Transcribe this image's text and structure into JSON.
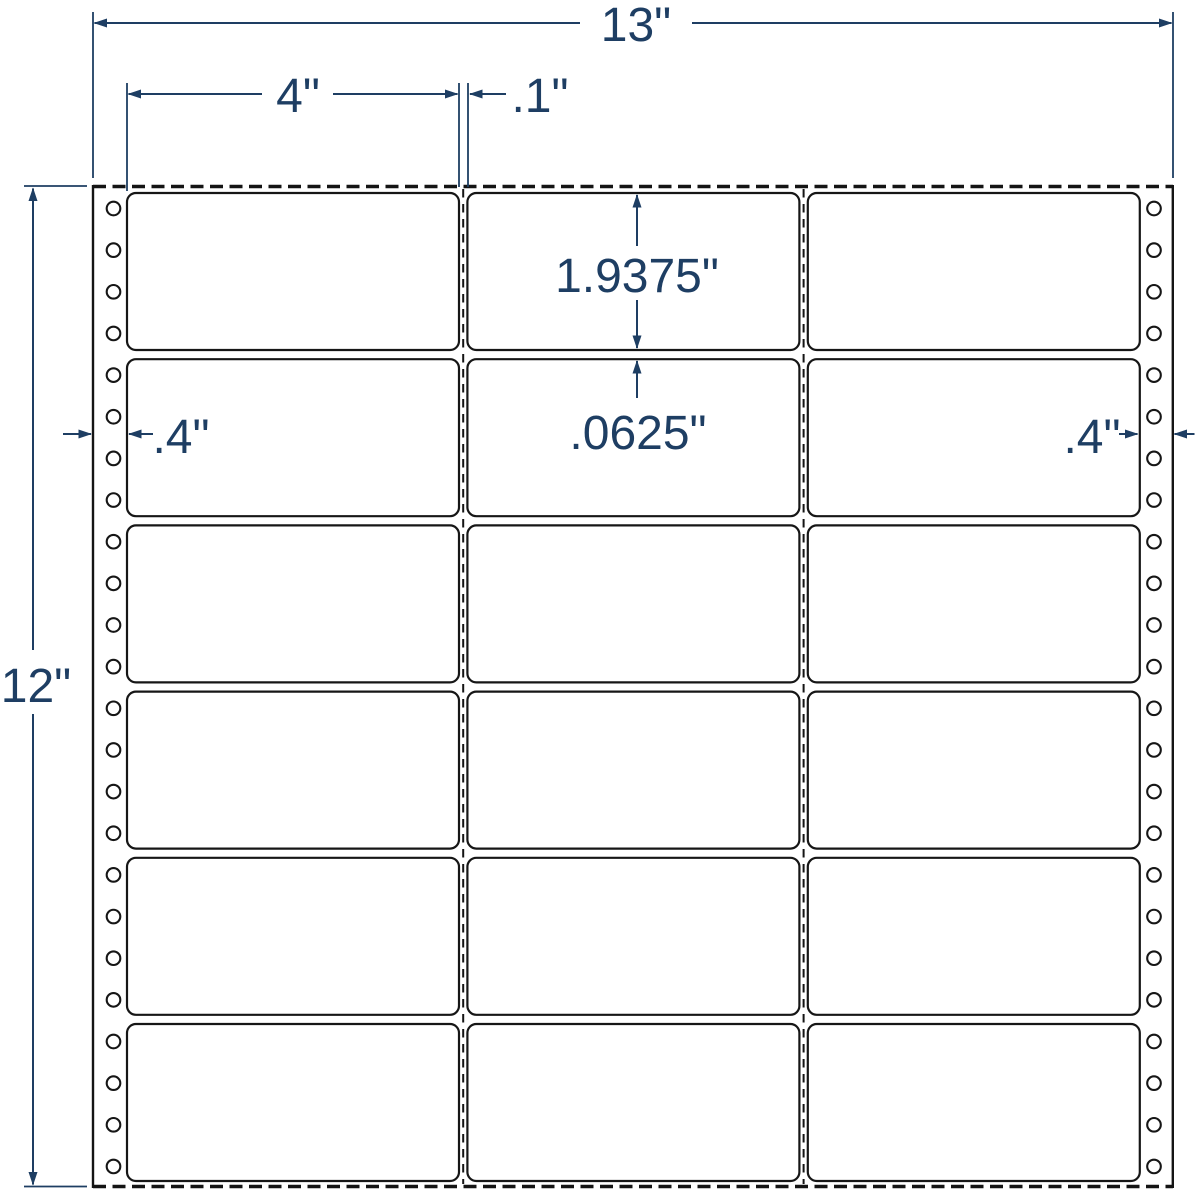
{
  "diagram": {
    "title": "pinfeed-label-sheet-dimension-spec",
    "colors": {
      "dimension_accent": "#1e3e63",
      "sheet_outline": "#141414",
      "background": "#ffffff"
    },
    "annotations": {
      "sheet_width": "13\"",
      "label_width": "4\"",
      "column_gap": ".1\"",
      "label_height": "1.9375\"",
      "row_gap": ".0625\"",
      "left_margin": ".4\"",
      "right_margin": ".4\"",
      "sheet_height": "12\""
    },
    "grid": {
      "rows": 6,
      "columns": 3,
      "label_count": 18
    },
    "tractor_feed": {
      "holes_per_side": 24,
      "sides": 2
    }
  }
}
